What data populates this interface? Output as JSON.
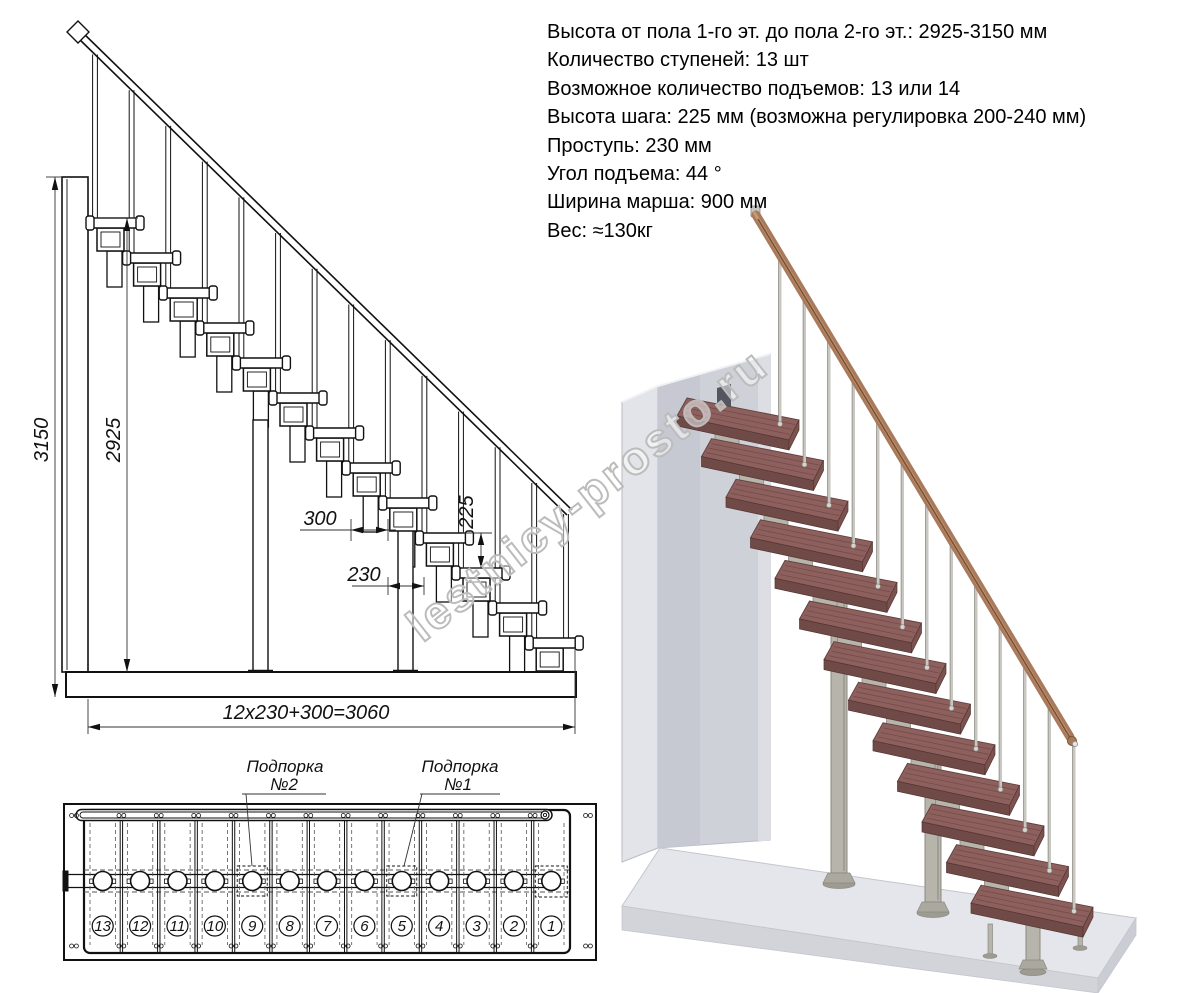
{
  "specs": {
    "lines": [
      "Высота от пола 1-го эт. до пола 2-го эт.: 2925-3150 мм",
      "Количество ступеней: 13 шт",
      "Возможное количество подъемов: 13 или 14",
      "Высота шага: 225 мм (возможна регулировка 200-240 мм)",
      "Проступь: 230 мм",
      "Угол подъема: 44 °",
      "Ширина марша: 900 мм",
      "Вес: ≈130кг"
    ]
  },
  "elevation": {
    "dims": {
      "total_height": "3150",
      "clear_height": "2925",
      "top_run": "300",
      "tread_depth": "230",
      "step_height": "225",
      "total_run": "12x230+300=3060"
    }
  },
  "plan": {
    "supports": [
      {
        "title": "Подпорка",
        "number": "№2"
      },
      {
        "title": "Подпорка",
        "number": "№1"
      }
    ],
    "step_numbers": [
      "13",
      "12",
      "11",
      "10",
      "9",
      "8",
      "7",
      "6",
      "5",
      "4",
      "3",
      "2",
      "1"
    ]
  },
  "watermark": {
    "text": "lestnicy-prosto.ru"
  },
  "colors": {
    "line": "#111111",
    "tread_top": "#8d605d",
    "tread_front": "#6f4a47",
    "tread_side": "#7c524e",
    "metal": "#b6b4ab",
    "metal_dark": "#8b897f",
    "wall_front": "#cfd1d9",
    "wall_side": "#e2e4e9",
    "wall_edge": "#b9bbc4",
    "floor_top": "#e4e6eb",
    "floor_front": "#d2d4da",
    "handrail": "#a87a5b",
    "handrail_light": "#c9a07d",
    "handrail_dark": "#7c5136",
    "watermark_outline": "#bcbcbc"
  }
}
